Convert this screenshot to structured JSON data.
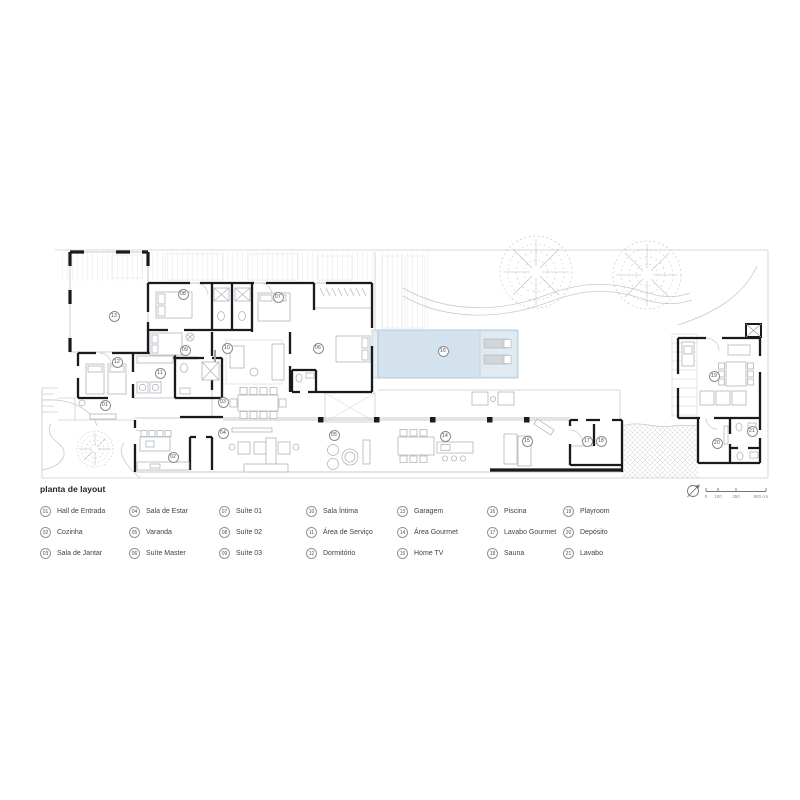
{
  "plan": {
    "colors": {
      "wall": "#1a1a1c",
      "furniture": "#b0b6bc",
      "site": "#c6cbcf",
      "pool_fill": "#d3e2ec",
      "pool_edge": "#aac3d4"
    },
    "room_markers": [
      {
        "n": "01",
        "x": 105,
        "y": 405
      },
      {
        "n": "02",
        "x": 173,
        "y": 457
      },
      {
        "n": "03",
        "x": 223,
        "y": 402
      },
      {
        "n": "04",
        "x": 223,
        "y": 433
      },
      {
        "n": "05",
        "x": 334,
        "y": 435
      },
      {
        "n": "06",
        "x": 318,
        "y": 348
      },
      {
        "n": "07",
        "x": 278,
        "y": 297
      },
      {
        "n": "08",
        "x": 183,
        "y": 294
      },
      {
        "n": "09",
        "x": 185,
        "y": 350
      },
      {
        "n": "10",
        "x": 227,
        "y": 348
      },
      {
        "n": "11",
        "x": 160,
        "y": 373
      },
      {
        "n": "12",
        "x": 117,
        "y": 362
      },
      {
        "n": "13",
        "x": 114,
        "y": 316
      },
      {
        "n": "14",
        "x": 445,
        "y": 436
      },
      {
        "n": "15",
        "x": 527,
        "y": 441
      },
      {
        "n": "16",
        "x": 443,
        "y": 351
      },
      {
        "n": "17",
        "x": 587,
        "y": 441
      },
      {
        "n": "18",
        "x": 601,
        "y": 441
      },
      {
        "n": "19",
        "x": 714,
        "y": 376
      },
      {
        "n": "20",
        "x": 717,
        "y": 443
      },
      {
        "n": "21",
        "x": 752,
        "y": 431
      }
    ]
  },
  "legend": {
    "title": "planta de layout",
    "columns": [
      [
        {
          "n": "01",
          "label": "Hall de Entrada"
        },
        {
          "n": "02",
          "label": "Cozinha"
        },
        {
          "n": "03",
          "label": "Sala de Jantar"
        }
      ],
      [
        {
          "n": "04",
          "label": "Sala de Estar"
        },
        {
          "n": "05",
          "label": "Varanda"
        },
        {
          "n": "06",
          "label": "Suíte Master"
        }
      ],
      [
        {
          "n": "07",
          "label": "Suíte 01"
        },
        {
          "n": "08",
          "label": "Suíte 02"
        },
        {
          "n": "09",
          "label": "Suíte 03"
        }
      ],
      [
        {
          "n": "10",
          "label": "Sala Íntima"
        },
        {
          "n": "11",
          "label": "Área de Serviço"
        },
        {
          "n": "12",
          "label": "Dormitório"
        }
      ],
      [
        {
          "n": "13",
          "label": "Garagem"
        },
        {
          "n": "14",
          "label": "Área Gourmet"
        },
        {
          "n": "15",
          "label": "Home TV"
        }
      ],
      [
        {
          "n": "16",
          "label": "Piscina"
        },
        {
          "n": "17",
          "label": "Lavabo Gourmet"
        },
        {
          "n": "18",
          "label": "Sauna"
        }
      ],
      [
        {
          "n": "19",
          "label": "Playroom"
        },
        {
          "n": "20",
          "label": "Depósito"
        },
        {
          "n": "21",
          "label": "Lavabo"
        }
      ]
    ]
  },
  "scalebar": {
    "tick_labels": [
      "0",
      "100",
      "250",
      "500 cm"
    ]
  }
}
